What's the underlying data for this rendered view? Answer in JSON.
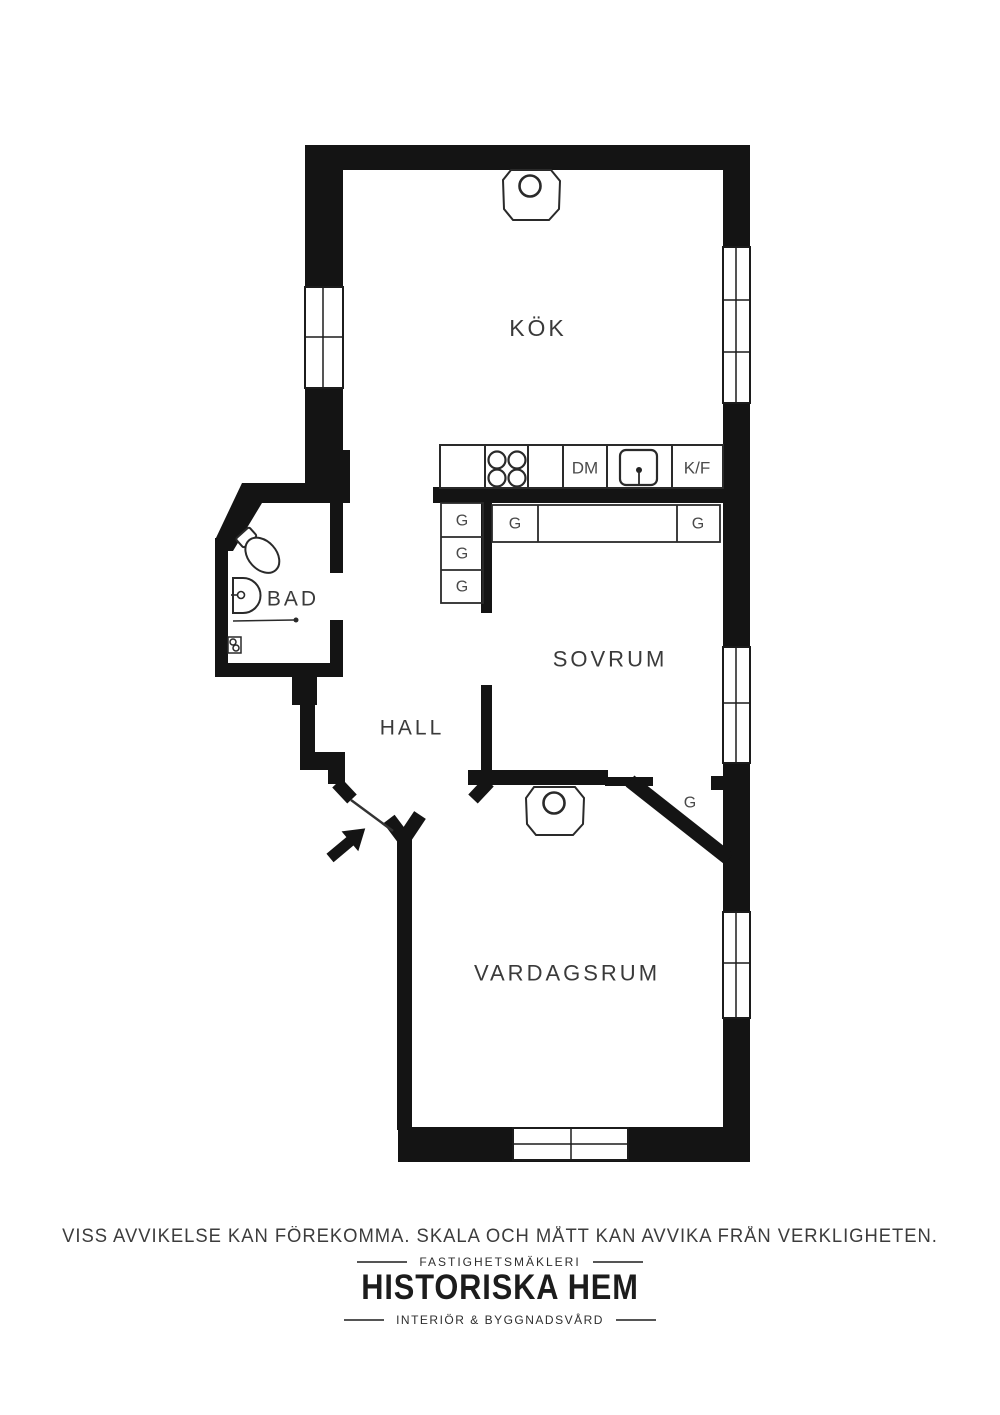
{
  "floorplan": {
    "rooms": {
      "kitchen": "KÖK",
      "bathroom": "BAD",
      "hall": "HALL",
      "bedroom": "SOVRUM",
      "living_room": "VARDAGSRUM"
    },
    "labels": {
      "dishwasher": "DM",
      "fridge_freezer": "K/F",
      "wardrobes": [
        "G",
        "G",
        "G",
        "G",
        "G",
        "G"
      ]
    }
  },
  "footer": {
    "disclaimer": "VISS AVVIKELSE KAN FÖREKOMMA. SKALA OCH MÅTT KAN AVVIKA FRÅN VERKLIGHETEN.",
    "brand_category": "FASTIGHETSMÄKLERI",
    "brand_name": "HISTORISKA HEM",
    "brand_tagline": "INTERIÖR & BYGGNADSVÅRD"
  },
  "colors": {
    "walls": "#141414",
    "line": "#222222",
    "label_text": "#3a3a3a",
    "background": "#ffffff"
  }
}
